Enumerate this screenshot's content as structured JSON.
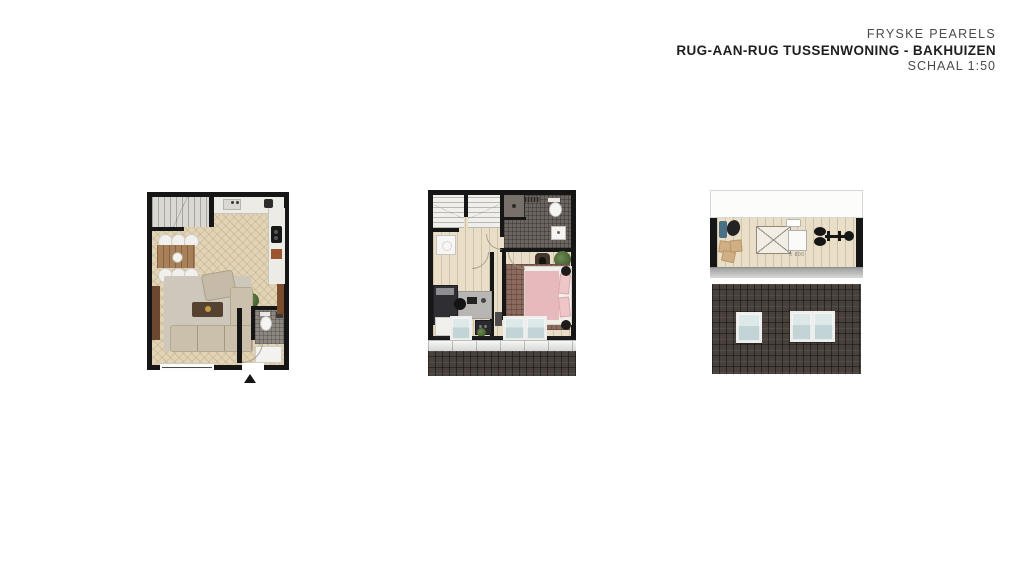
{
  "header": {
    "project_name": "FRYSKE PEARELS",
    "drawing_title": "RUG-AAN-RUG TUSSENWONING - BAKHUIZEN",
    "scale": "SCHAAL 1:50"
  },
  "plans": [
    {
      "name": "ground-floor",
      "features": [
        "staircase",
        "dining-table-six-chairs",
        "kitchen",
        "living-room-sofa",
        "toilet",
        "entrance-arrow"
      ]
    },
    {
      "name": "first-floor",
      "features": [
        "double-staircase",
        "bathroom",
        "bedroom-left",
        "bedroom-right",
        "dormer-windows",
        "roof-edge"
      ]
    },
    {
      "name": "attic-and-roof",
      "features": [
        "lounge-corner",
        "void-opening",
        "skylight",
        "fitness-equipment",
        "roof-with-three-windows"
      ],
      "dimension_label": "± 800"
    }
  ],
  "colors": {
    "wall": "#161616",
    "herringbone_floor": "#e1d3b5",
    "plank_floor": "#e9dfc8",
    "roof_tiles": "#48403b",
    "bathroom_tiles": "#6b6460",
    "bed_pink": "#e6b9bc",
    "window_glass": "#ccdadd",
    "title_text": "#1f1f1f",
    "subtitle_text": "#4b4b4b"
  }
}
